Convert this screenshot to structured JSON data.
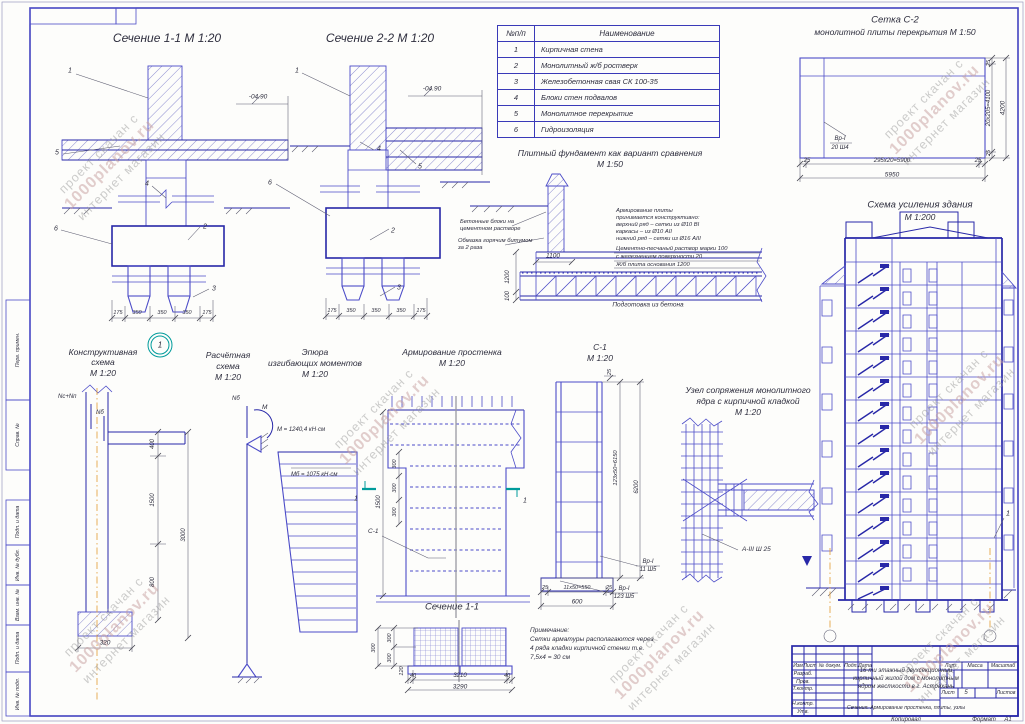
{
  "wm": {
    "l1": "проект скачан с",
    "l2": "1000planov.ru",
    "l3": "интернет магазин"
  },
  "s11": {
    "title": "Сечение 1-1 М 1:20",
    "level": "-04.90",
    "dims": [
      "175",
      "350",
      "350",
      "350",
      "175"
    ],
    "c1": "1",
    "c2": "2",
    "c3": "3",
    "c4": "4",
    "c5": "5",
    "c6": "6"
  },
  "s22": {
    "title": "Сечение 2-2 М 1:20",
    "level": "-04.90",
    "dims": [
      "175",
      "350",
      "350",
      "350",
      "175"
    ],
    "c1": "1",
    "c2": "2",
    "c3": "3",
    "c4": "4",
    "c5": "5",
    "c6": "6"
  },
  "legend": {
    "h1": "№п/п",
    "h2": "Наименование",
    "rows": [
      {
        "n": "1",
        "name": "Кирпичная стена"
      },
      {
        "n": "2",
        "name": "Монолитный ж/б ростверк"
      },
      {
        "n": "3",
        "name": "Железобетонная свая СК 100-35"
      },
      {
        "n": "4",
        "name": "Блоки стен подвалов"
      },
      {
        "n": "5",
        "name": "Монолитное перекрытие"
      },
      {
        "n": "6",
        "name": "Гидроизоляция"
      }
    ]
  },
  "plate": {
    "t1": "Плитный фундамент как вариант сравнения",
    "t2": "М 1:50",
    "nl1a": "Бетонные блоки на",
    "nl1b": "цементном растворе",
    "nl2a": "Обмазка горячим битумом",
    "nl2b": "за 2 раза",
    "nr": [
      "Армирование плиты",
      "принимается конструктивно:",
      "верхний ряд – сетки из Ø10 ВI",
      "каркасы – из Ø10 АII",
      "нижний ряд – сетки из Ø16 АIII",
      "Цементно-песчаный раствор марки 100",
      "с железнением поверхности  20",
      "Ж/б плита основания  1200"
    ],
    "d1100": "1100",
    "d1200": "1200",
    "d100": "100",
    "bottom": "Подготовка из бетона"
  },
  "c2": {
    "t1": "Сетка С-2",
    "t2": "монолитной плиты перекрытия М 1:50",
    "lbl1": "Вр-I",
    "lbl2": "20 Ш4",
    "dl": "25",
    "dm": "295х20=5900",
    "dr": "25",
    "total": "5950",
    "vr_top": "25",
    "vr_mid": "20х205=4100",
    "vr_bot": "25",
    "vtotal": "4200"
  },
  "bld": {
    "t1": "Схема усиления здания",
    "t2": "М 1:200",
    "callout": "1"
  },
  "cons": {
    "t1": "Конструктивная",
    "t2": "схема",
    "t3": "М 1:20",
    "detail": "1",
    "load1": "Nс+Nп",
    "load2": "Nб",
    "d400": "400",
    "d1500": "1500",
    "d800": "800",
    "d3000": "3000",
    "d320": "320"
  },
  "calc": {
    "t1": "Расчётная",
    "t2": "схема",
    "t3": "М 1:20",
    "force": "Nб",
    "moment": "М"
  },
  "ep": {
    "t1": "Эпюра",
    "t2": "изгибающих моментов",
    "t3": "М 1:20",
    "m1": "М = 1240,4 кН·см",
    "m2": "Мб = 1075 кН·см"
  },
  "pier": {
    "t1": "Армирование простенка",
    "t2": "М 1:20",
    "d1500": "1500",
    "d300": "300",
    "c1lbl": "С-1",
    "cut": "1"
  },
  "c1d": {
    "t1": "С-1",
    "t2": "М 1:20",
    "d25t": "25",
    "dside": "123х50=6150",
    "dtotal": "6200",
    "d25a": "25",
    "dmid": "11х50=550",
    "d25b": "25",
    "d600": "600",
    "l1a": "Вр-I",
    "l1b": "11 Ш5",
    "l2a": "Вр-I",
    "l2b": "123 Ш5"
  },
  "node": {
    "t1": "Узел сопряжения монолитного",
    "t2": "ядра с кирпичной кладкой",
    "t3": "М 1:20",
    "rebar": "А-III Ш 25"
  },
  "s11b": {
    "title": "Сечение 1-1",
    "d300": "300",
    "d120": "120",
    "d40": "40",
    "d3210": "3210",
    "d3290": "3290"
  },
  "note": {
    "l1": "Примечание:",
    "l2": "Сетки арматуры располагаются через",
    "l3": "4 ряда кладки кирпичной стенки т.е.",
    "l4": "7,5х4 = 30 см"
  },
  "stamp": {
    "c_izm": "Изм",
    "c_list": "Лист",
    "c_doc": "№ докум.",
    "c_podp": "Подп.",
    "c_data": "Дата",
    "r1": "Разраб.",
    "r2": "Пров.",
    "r3": "Т.контр.",
    "r4": "Н.контр.",
    "r5": "Утв.",
    "title1": "16-ти этажный двухсекционный",
    "title2": "кирпичный жилой дом с монолитным",
    "title3": "ядром жесткости в г. Астрахань",
    "subtitle": "Сечения. Армирование простенка, плиты, узлы",
    "lit": "Лит.",
    "mass": "Масса",
    "scale": "Масштаб",
    "sheet_lbl": "Лист",
    "sheet_num": "5",
    "sheets_lbl": "Листов",
    "kop": "Копировал",
    "fmt": "Формат",
    "fmt_val": "А1"
  },
  "edge": {
    "e1": "Перв. примен.",
    "e2": "Справ. №",
    "e3": "Подп. и дата",
    "e4": "Инв. № дубл.",
    "e5": "Взам. инв. №",
    "e6": "Подп. и дата",
    "e7": "Инв. № подл."
  },
  "colors": {
    "line_blue": "#4c4cc8",
    "line_navy": "#2828a8",
    "teal": "#009b9b",
    "axis_orange": "#e09a30",
    "watermark_pink": "#c79f9f"
  }
}
